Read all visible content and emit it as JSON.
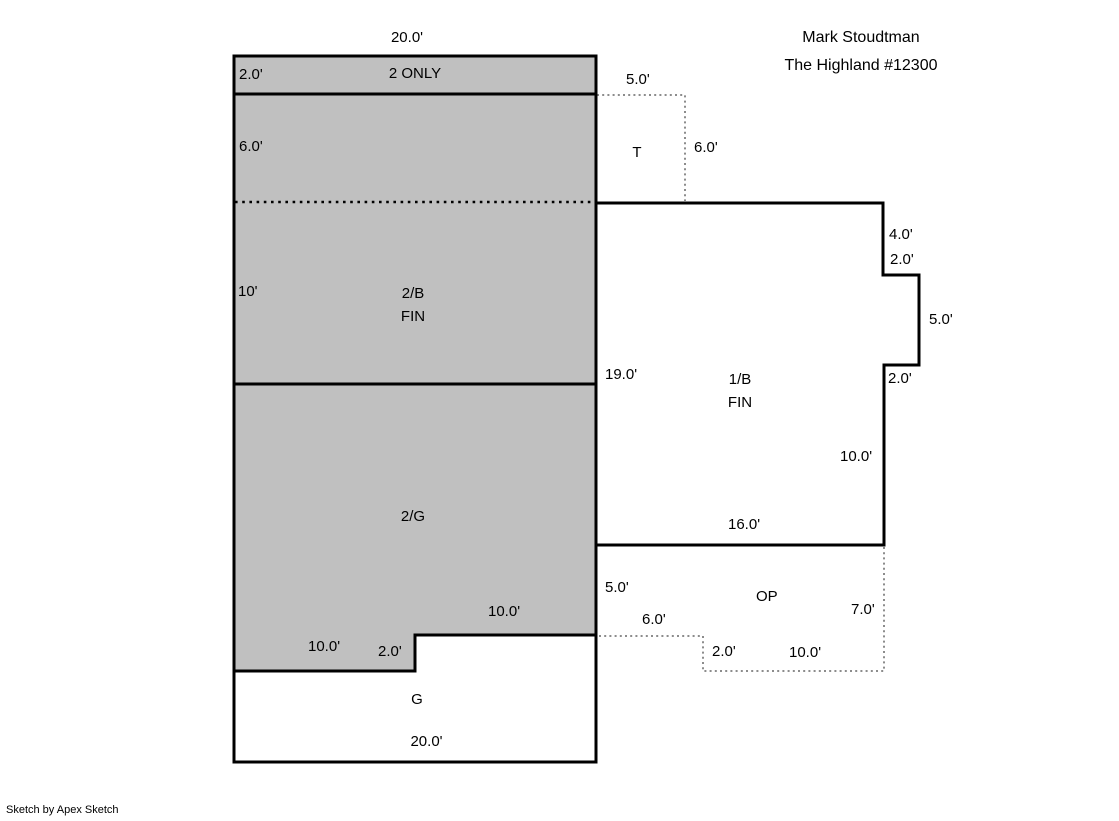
{
  "header": {
    "owner_name": "Mark Stoudtman",
    "plan_name": "The Highland #12300"
  },
  "footer": {
    "credit": "Sketch by Apex Sketch"
  },
  "rooms": {
    "second_only_label": "2 ONLY",
    "second_basement_label": "2/B",
    "second_basement_sub": "FIN",
    "second_garage_label": "2/G",
    "garage_label": "G",
    "first_basement_label": "1/B",
    "first_basement_sub": "FIN",
    "terrace_label": "T",
    "open_porch_label": "OP"
  },
  "dims": {
    "top_width": "20.0'",
    "strip_height": "2.0'",
    "upper_height": "6.0'",
    "t_width": "5.0'",
    "t_height": "6.0'",
    "b2_height": "10'",
    "b1_left_height": "19.0'",
    "b1_notch_top": "4.0'",
    "b1_notch_in": "2.0'",
    "b1_notch_right": "5.0'",
    "b1_notch_out": "2.0'",
    "b1_right_height": "10.0'",
    "b1_bottom_width": "16.0'",
    "op_left_height": "5.0'",
    "op_step_width": "6.0'",
    "op_right_height": "7.0'",
    "op_step_height": "2.0'",
    "op_bottom_width": "10.0'",
    "g2_bottom_right_width": "10.0'",
    "g_step_top_width": "10.0'",
    "g_step_height": "2.0'",
    "g_bottom_width": "20.0'"
  },
  "colors": {
    "wall_color": "#000000",
    "area_fill": "#c0c0c0",
    "dotted_color": "#8c8c8c",
    "page_bg": "#ffffff"
  }
}
